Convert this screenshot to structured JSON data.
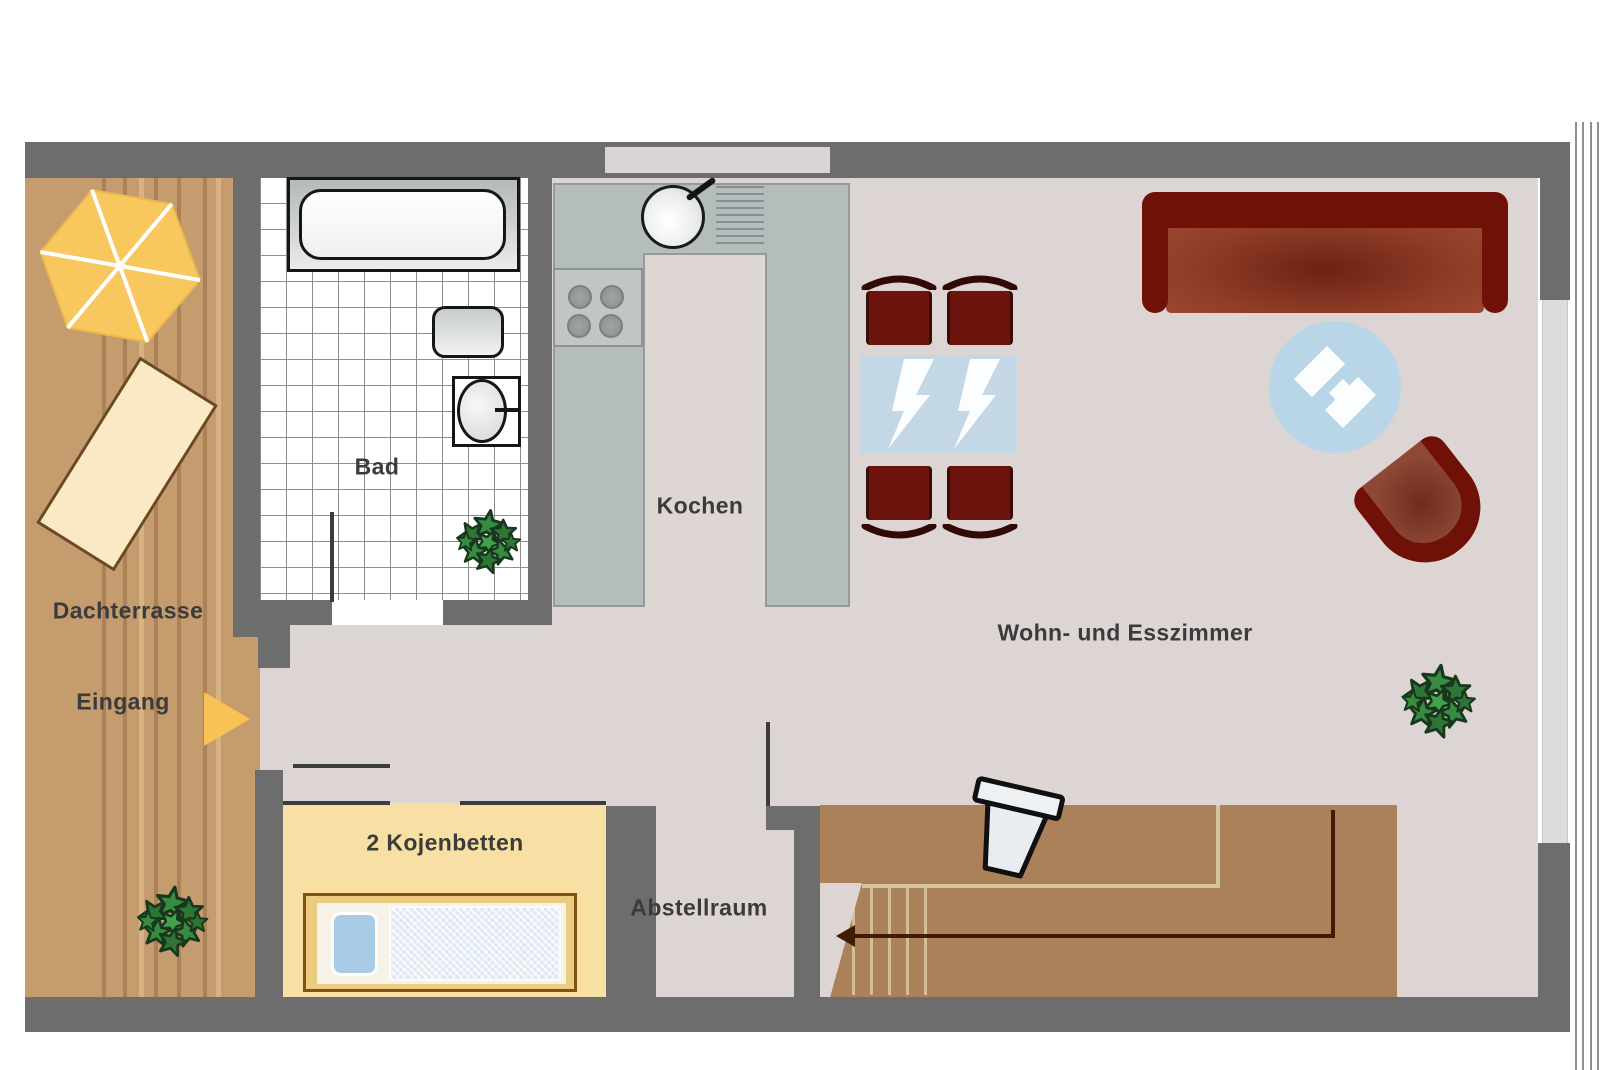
{
  "rooms": {
    "terrace": {
      "label": "Dachterrasse"
    },
    "entrance": {
      "label": "Eingang"
    },
    "bathroom": {
      "label": "Bad"
    },
    "kitchen": {
      "label": "Kochen"
    },
    "living_dining": {
      "label": "Wohn- und Esszimmer"
    },
    "bunk_room": {
      "label": "2 Kojenbetten"
    },
    "storage": {
      "label": "Abstellraum"
    }
  },
  "colors": {
    "wall": "#6d6d6d",
    "floor": "#ddd5d3",
    "terrace_wood": "#c59c6e",
    "terrace_plank_dark": "#ab8157",
    "bath_tile": "#ffffff",
    "kitchen_counter": "#b5bcbc",
    "bunk_room_floor": "#f8e0a4",
    "stairwell_wood": "#aa8159",
    "stair_arrow": "#3f1d05",
    "chair_red": "#6d140e",
    "sofa_frame": "#701108",
    "sofa_seat": "#9c4a33",
    "dining_table_blue": "#c3d8e4",
    "coffee_table_blue": "#b9d6e8",
    "umbrella_yellow": "#f8c75d",
    "entry_arrow_yellow": "#f9c254",
    "bed_frame": "#eccb81",
    "bed_pillow": "#a9cce6",
    "plant_green": "#388c41",
    "wall_window_inset": "#dad4d4"
  },
  "furniture": {
    "bathroom": [
      "bathtub",
      "washbasin",
      "toilet",
      "plant"
    ],
    "kitchen": [
      "sink",
      "drainer",
      "stove-4-burners"
    ],
    "living_dining": [
      "dining-table",
      "4-chairs",
      "sofa",
      "round-coffee-table",
      "armchair",
      "plant"
    ],
    "bunk_room": [
      "bunk-bed"
    ],
    "terrace": [
      "sun-umbrella",
      "lounger",
      "plant",
      "entrance-arrow"
    ],
    "stairwell": [
      "stairs-down-arrow",
      "flower-pot"
    ]
  }
}
